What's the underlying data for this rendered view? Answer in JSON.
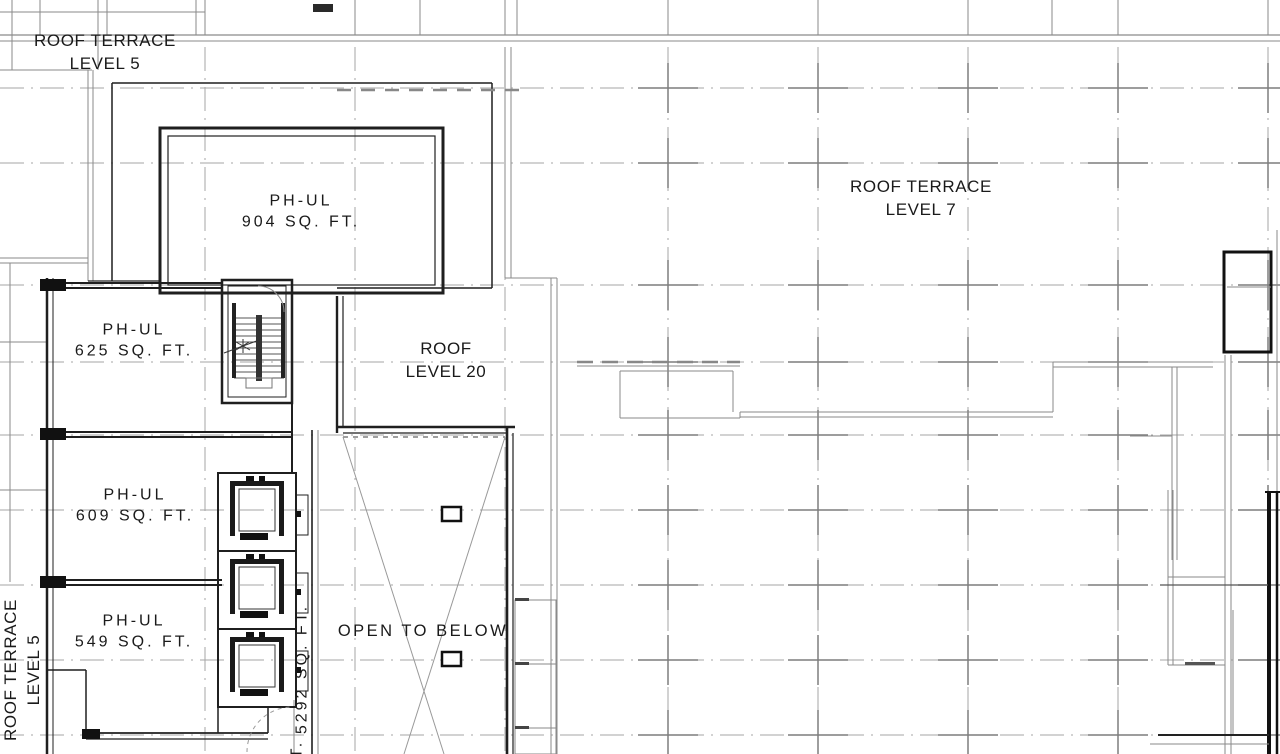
{
  "labels": {
    "roof_terrace_level5_top": {
      "line1": "ROOF TERRACE",
      "line2": "LEVEL 5"
    },
    "roof_level20": {
      "line1": "ROOF",
      "line2": "LEVEL 20"
    },
    "roof_terrace_level7": {
      "line1": "ROOF TERRACE",
      "line2": "LEVEL 7"
    },
    "open_to_below": "OPEN TO BELOW",
    "roof_terrace_level5_side": {
      "line1": "ROOF TERRACE",
      "line2": "LEVEL 5"
    },
    "area_5292": "5292 SQ. FT.",
    "partial_text_bottom": "T."
  },
  "rooms": [
    {
      "name": "PH-UL",
      "area": "904 SQ. FT."
    },
    {
      "name": "PH-UL",
      "area": "625 SQ. FT."
    },
    {
      "name": "PH-UL",
      "area": "609 SQ. FT."
    },
    {
      "name": "PH-UL",
      "area": "549 SQ. FT."
    }
  ],
  "colors": {
    "background": "#ffffff",
    "wall_heavy": "#1c1c1c",
    "wall_light": "#8a8a8a",
    "grid": "#a6a6a6",
    "text": "#1a1a1a"
  }
}
